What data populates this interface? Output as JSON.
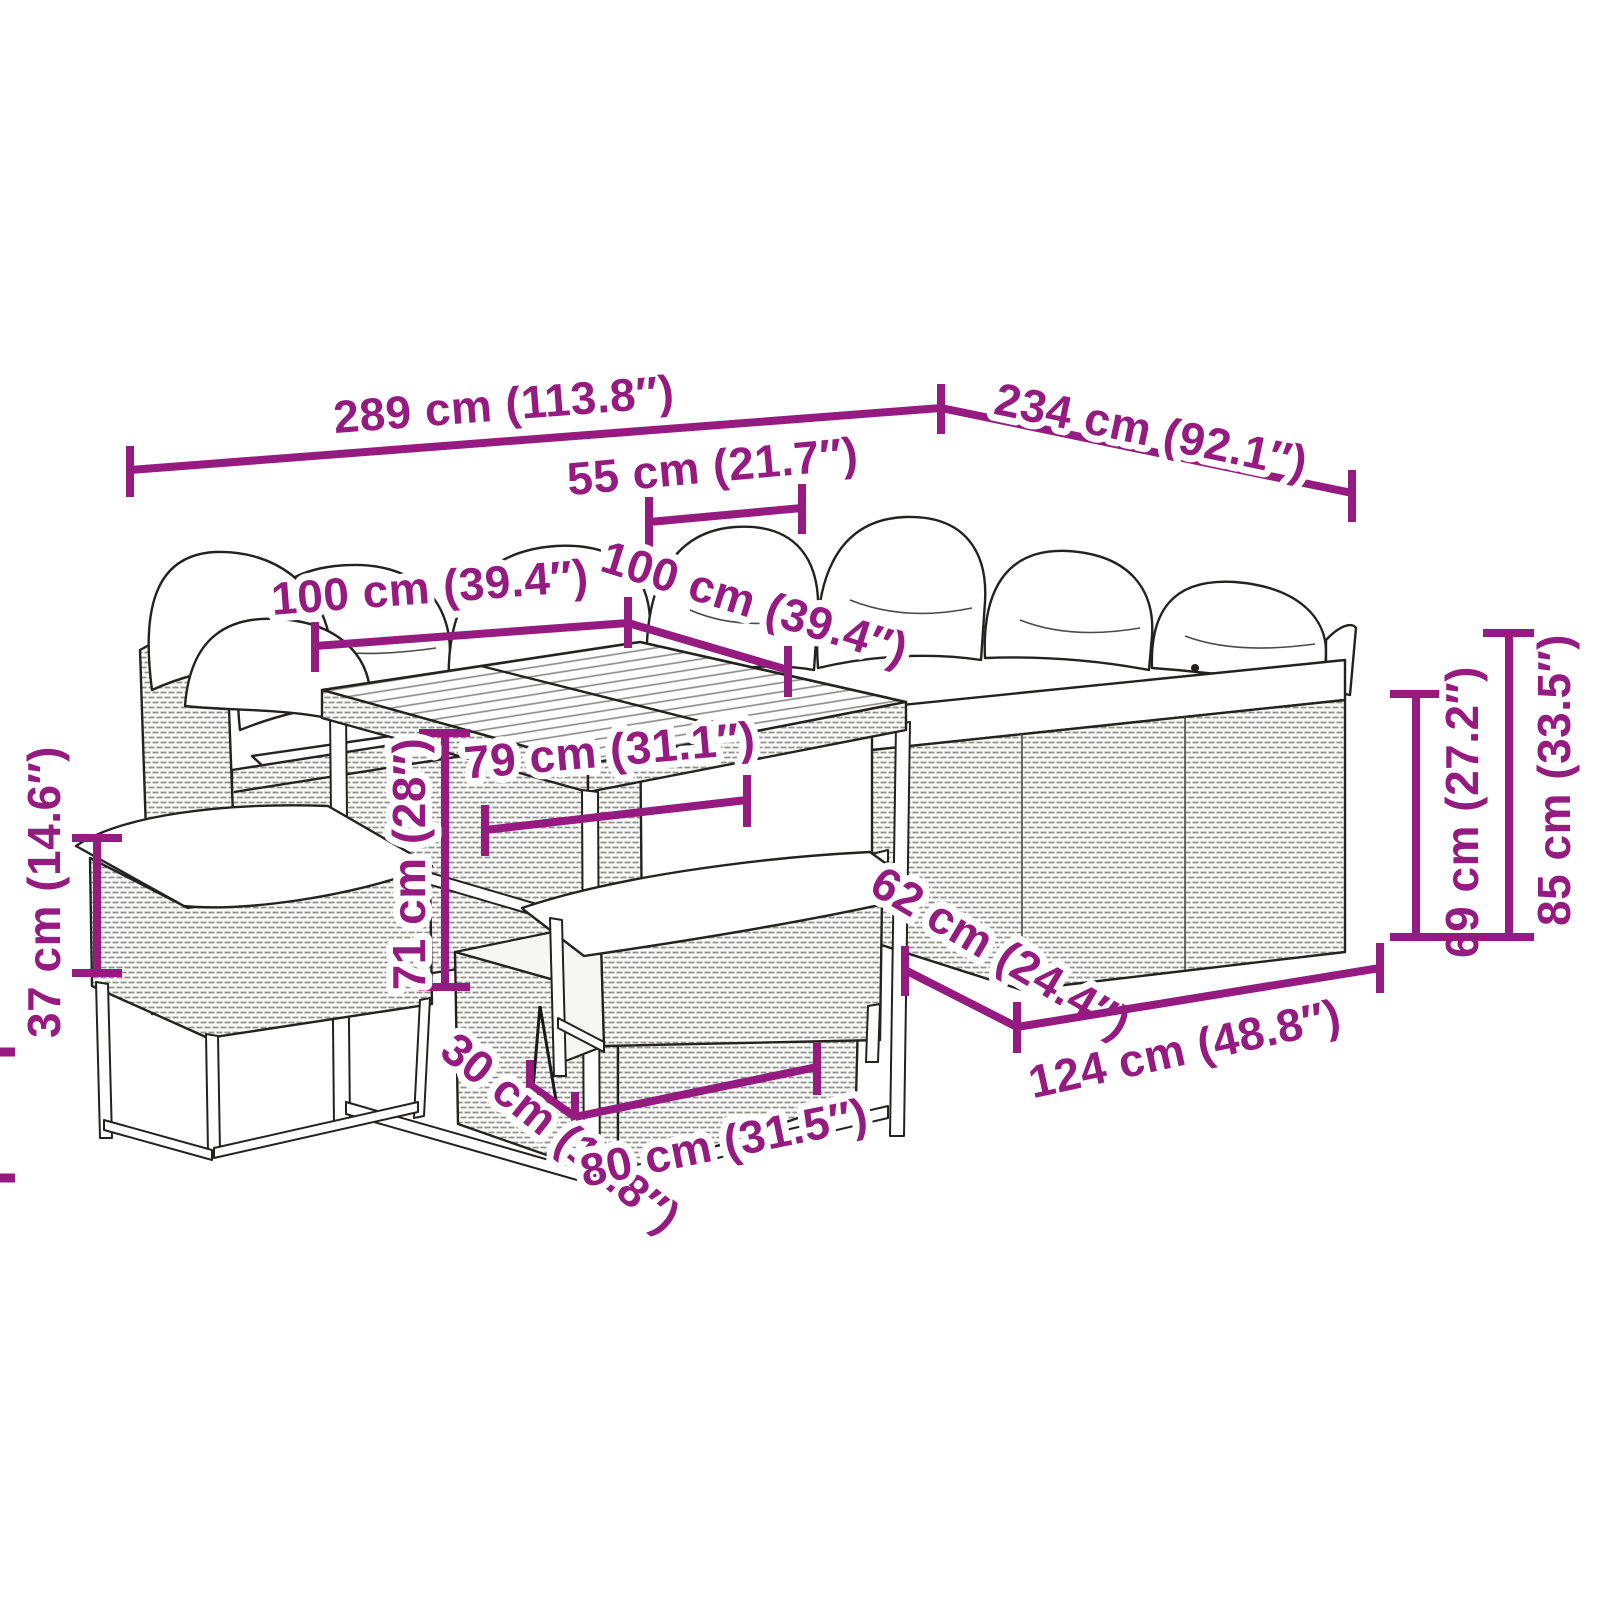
{
  "page": {
    "background": "#ffffff",
    "accent_color": "#951b81",
    "sketch_line_color": "#232220"
  },
  "illustration": {
    "subject": "poly rattan garden lounge set: corner sofa with cushions, height-adjustable cube dining table, right sofa section and two cushioned benches",
    "style": "black-and-white outline product sketch with magenta dimension lines"
  },
  "dimensions": {
    "d289": "289 cm (113.8″)",
    "d234": "234 cm (92.1″)",
    "d55": "55 cm (21.7″)",
    "d100a": "100 cm (39.4″)",
    "d100b": "100 cm (39.4″)",
    "d79": "79 cm (31.1″)",
    "d71": "71 cm (28″)",
    "d37": "37 cm (14.6″)",
    "d30": "30 cm (11.8″)",
    "d80": "80 cm (31.5″)",
    "d62": "62 cm (24.4″)",
    "d124": "124 cm (48.8″)",
    "d69": "69 cm (27.2″)",
    "d85": "85 cm (33.5″)"
  }
}
